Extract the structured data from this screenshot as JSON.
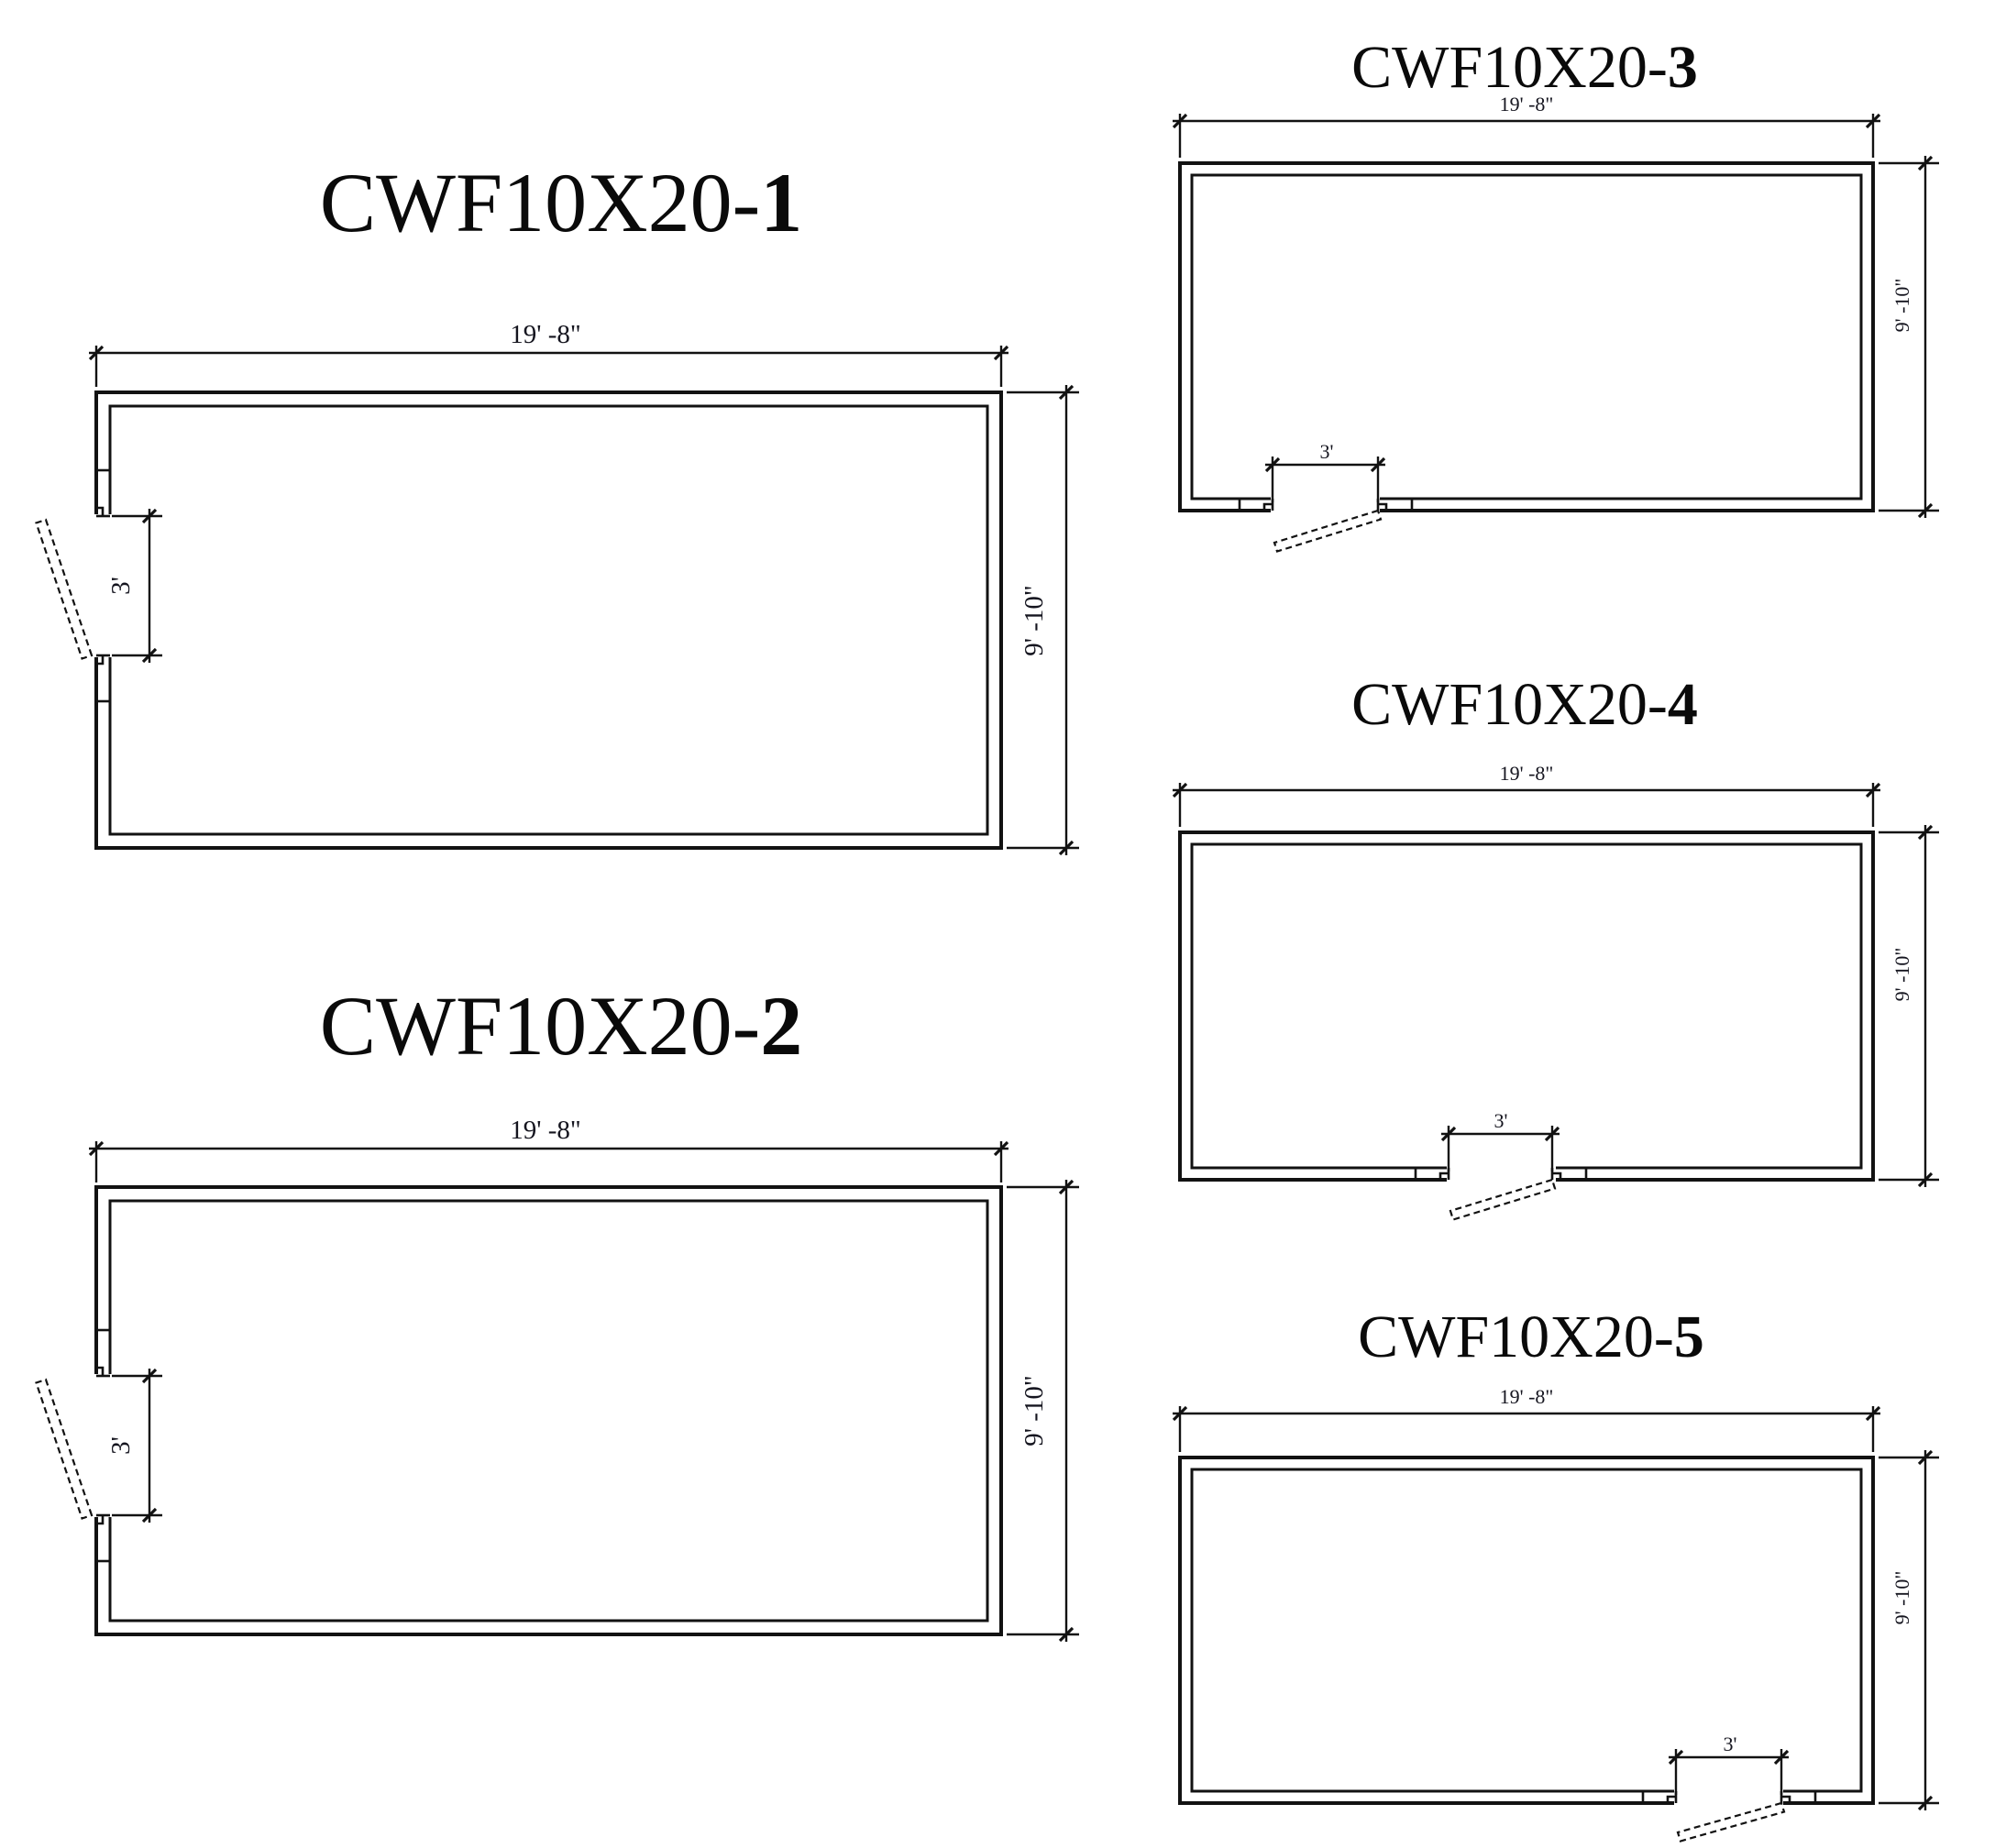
{
  "page": {
    "background": "#ffffff",
    "line_color": "#121212",
    "text_color": "#15151f"
  },
  "plans": [
    {
      "name": "CWF10X20-1",
      "title_base": "CWF10X20-",
      "title_num": "1",
      "width_label": "19' -8\"",
      "height_label": "9' -10\"",
      "door": {
        "wall": "left",
        "position": "upper-left",
        "width_label": "3'"
      }
    },
    {
      "name": "CWF10X20-2",
      "title_base": "CWF10X20-",
      "title_num": "2",
      "width_label": "19' -8\"",
      "height_label": "9' -10\"",
      "door": {
        "wall": "left",
        "position": "middle-left",
        "width_label": "3'"
      }
    },
    {
      "name": "CWF10X20-3",
      "title_base": "CWF10X20-",
      "title_num": "3",
      "width_label": "19' -8\"",
      "height_label": "9' -10\"",
      "door": {
        "wall": "bottom",
        "position": "bottom-left",
        "width_label": "3'"
      }
    },
    {
      "name": "CWF10X20-4",
      "title_base": "CWF10X20-",
      "title_num": "4",
      "width_label": "19' -8\"",
      "height_label": "9' -10\"",
      "door": {
        "wall": "bottom",
        "position": "bottom-center",
        "width_label": "3'"
      }
    },
    {
      "name": "CWF10X20-5",
      "title_base": "CWF10X20-",
      "title_num": "5",
      "width_label": "19' -8\"",
      "height_label": "9' -10\"",
      "door": {
        "wall": "bottom",
        "position": "bottom-right",
        "width_label": "3'"
      }
    }
  ]
}
